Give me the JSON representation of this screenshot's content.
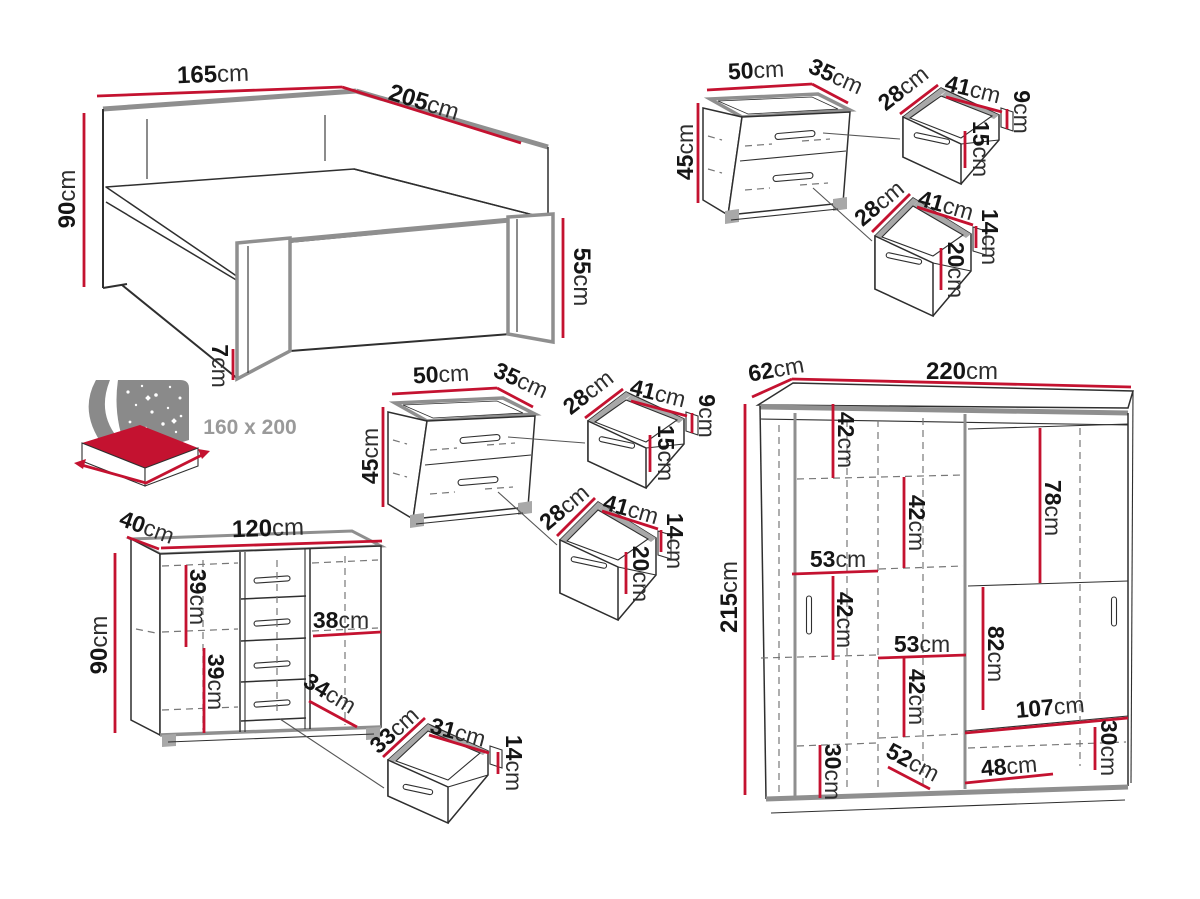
{
  "unit": "cm",
  "palette": {
    "dimension_red": "#c41230",
    "outline_gray": "#8f8f8f",
    "line_dark": "#2f2f2f",
    "text_dark": "#151515",
    "muted_gray": "#9a9a9a",
    "background": "#ffffff"
  },
  "bed": {
    "width": "165",
    "length": "205",
    "height": "90",
    "footboard_height": "55",
    "base_height": "7",
    "mattress_size": "160 x 200"
  },
  "nightstand": {
    "width": "50",
    "depth": "35",
    "height": "45",
    "top_drawer": {
      "depth": "28",
      "width": "41",
      "side_height": "9",
      "front_height": "15"
    },
    "bottom_drawer": {
      "depth": "28",
      "width": "41",
      "side_height": "14",
      "front_height": "20"
    }
  },
  "chest": {
    "depth": "40",
    "width": "120",
    "height": "90",
    "upper_left": "39",
    "lower_left": "39",
    "door_shelf": "38",
    "lower_right": "34",
    "drawer": {
      "depth": "33",
      "width": "31",
      "height": "14"
    }
  },
  "wardrobe": {
    "depth": "62",
    "width": "220",
    "height": "215",
    "interior": {
      "left_top": "42",
      "center_top": "42",
      "right_hanging": "78",
      "left_shelf": "53",
      "left_mid": "42",
      "center_shelf": "53",
      "center_mid": "42",
      "center_hanging": "82",
      "bottom_shelf": "107",
      "bottom_right": "30",
      "bottom_left": "30",
      "floor_depth": "52",
      "floor_width": "48"
    }
  }
}
